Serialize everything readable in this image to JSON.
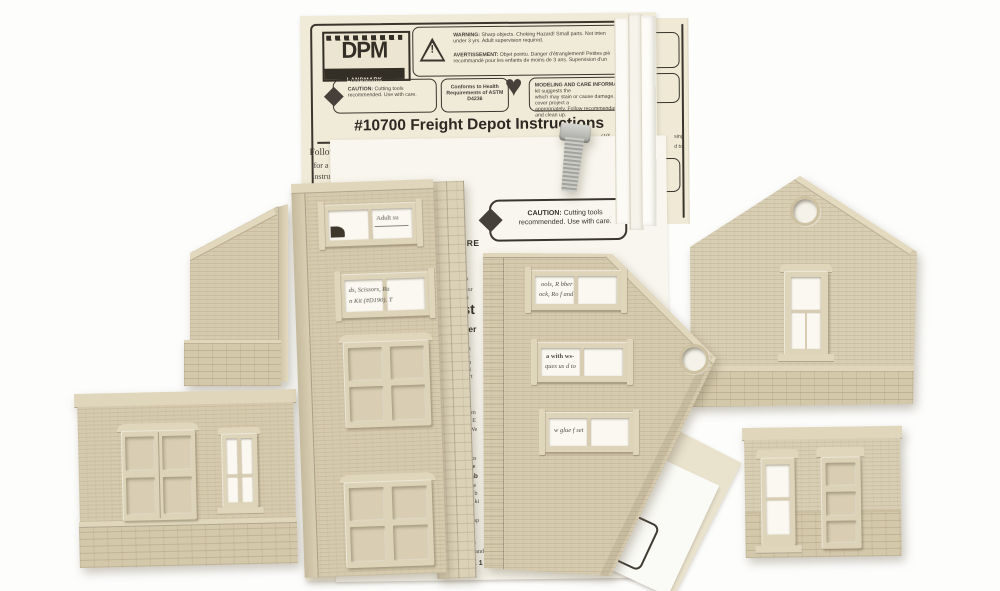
{
  "sheet": {
    "logo_text": "DPM",
    "logo_subtitle": "LANDMARK STRUCTURES™",
    "warning_label": "WARNING:",
    "warning_line1": "Sharp objects. Choking Hazard! Small parts. Not inten",
    "warning_line2": "under 3 yrs. Adult supervision required.",
    "avert_label": "AVERTISSEMENT:",
    "avert_line1": "Objet pointu. Danger d'étranglement! Petites piè",
    "avert_line2": "recommandé pour les enfants de moins de 3 ans. Supervision d'un",
    "caution_label": "CAUTION:",
    "caution_text": "Cutting tools recommended. Use with care.",
    "astm_text": "Conforms to Health Requirements of ASTM D4236",
    "care_label": "MODELING AND CARE INFORMATION:",
    "care_line1": "This kit suggests the",
    "care_line2": "which may stain or cause damage. Take care to cover project a",
    "care_line3": "appropriately. Follow recommendations for use and clean up.",
    "title": "#10700 Freight Depot Instructions",
    "body_line1": "Follow  the  enclosed  HO  scale  General  Instructions",
    "body_chimneys": "Chimneys",
    "body_stub1": "for a",
    "body_stub2": "Instru",
    "body_stub3": "includ",
    "body_stub4": "befor",
    "margin_frag1": "(10'",
    "margin_frag2": "ht w"
  },
  "sheet1b": {
    "frag1": "ten",
    "frag2": "ue",
    "frag3": "outs",
    "frag4": "ing",
    "frag5": "bor",
    "frag6": "sing",
    "frag7": "d to"
  },
  "sheet2": {
    "yrs_text": "3 yrs.",
    "caution_label": "CAUTION:",
    "caution_text": "Cutting tools recommended. Use with care.",
    "care_heading": "CARE",
    "strip_fragments": [
      "by  k",
      "tic or",
      "tion",
      "st",
      "Ser",
      "gin",
      "ies.",
      "e b",
      "to i",
      "part",
      "cem",
      "er. E",
      "r We",
      "a m",
      "ove",
      "Tab",
      "ape",
      "of b",
      "If ki",
      "ar",
      "n sp",
      "av",
      "n and",
      "s. 1"
    ]
  },
  "windows": {
    "c1": "Adult su",
    "c2_line1": "ds, Scissors, Ru",
    "c2_line2": "n Kit (#D190). T",
    "d1_line1": "ools, R bber",
    "d1_line2": "ock, Ro f and",
    "d2_line1": "a with  ws-",
    "d2_line2": "ques us d to",
    "d3": "w glue f  set"
  },
  "colors": {
    "plastic": "#d6caae",
    "plastic_light": "#e0d6bc",
    "plastic_dark": "#c3b697",
    "sheet_cream": "#f0ead8",
    "sheet_white": "#f8f6ee",
    "ink": "#3a362e",
    "metal": "#b9b8b4"
  }
}
